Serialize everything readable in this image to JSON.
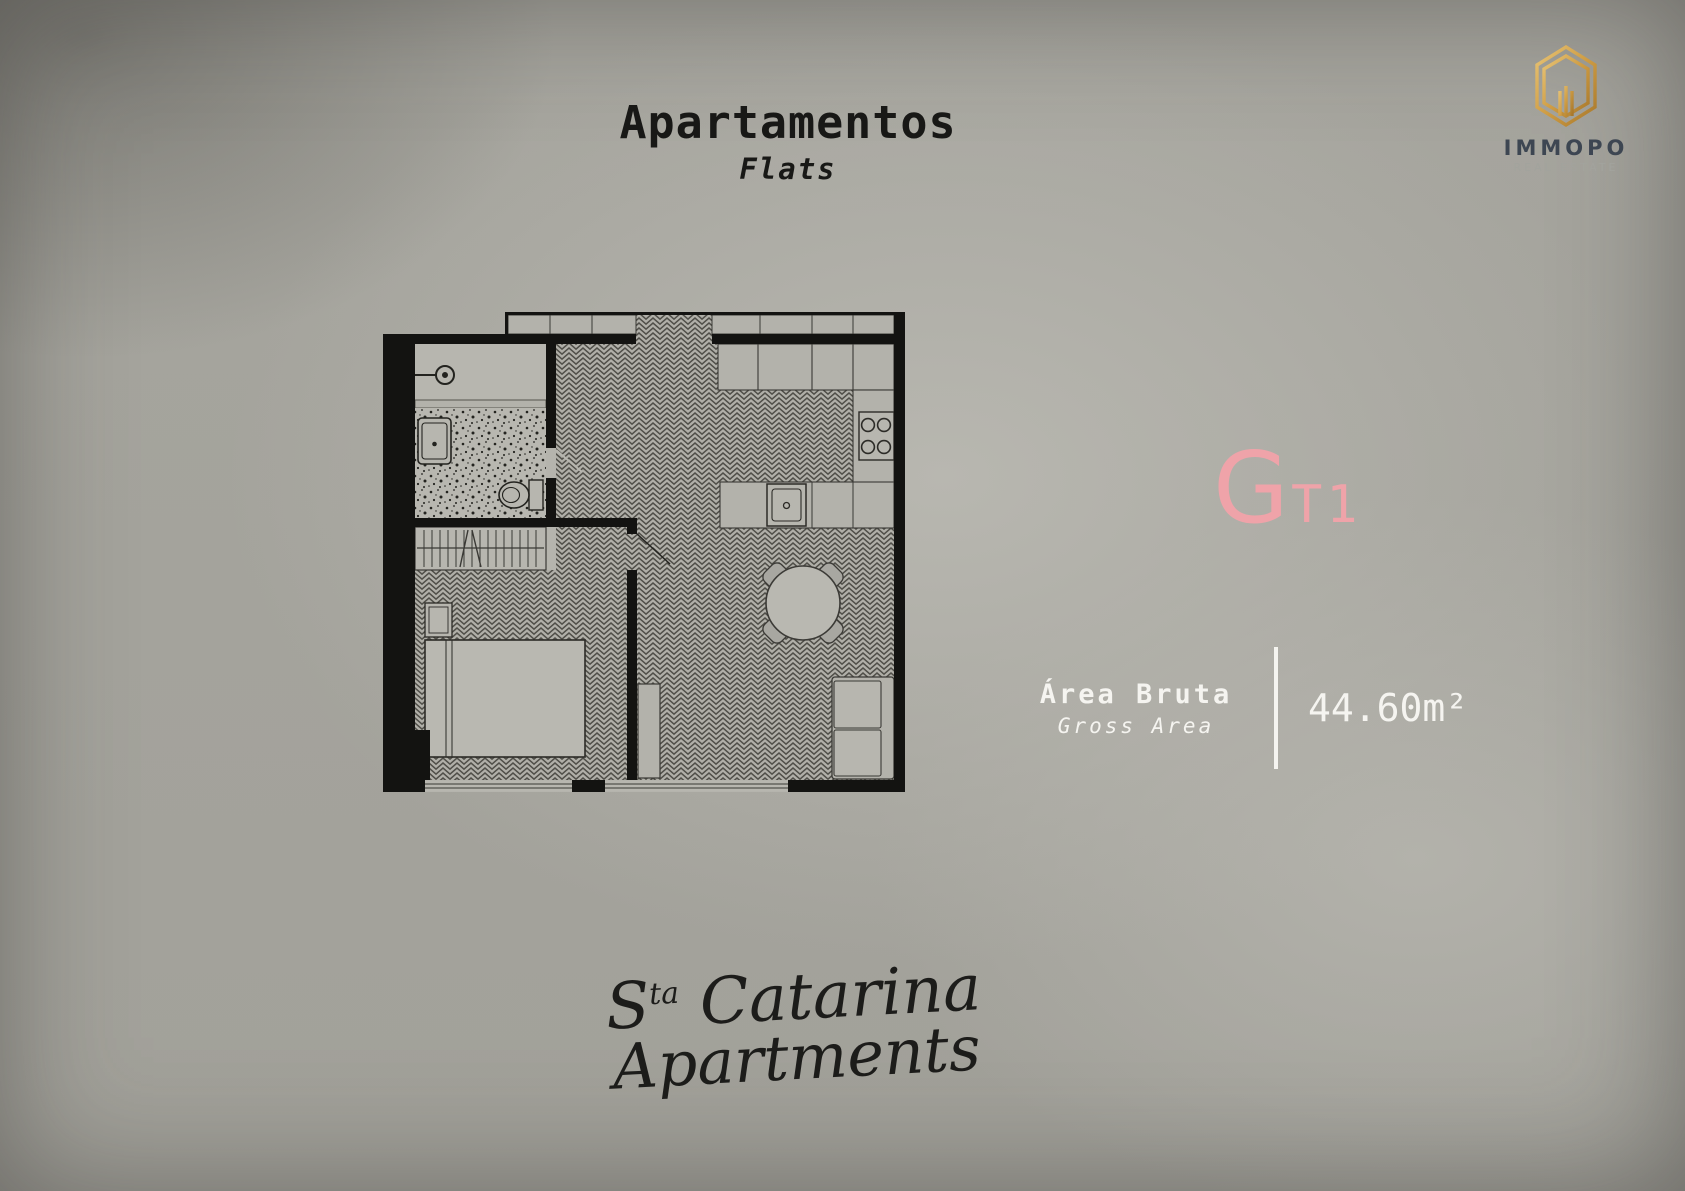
{
  "header": {
    "title": "Apartamentos",
    "subtitle": "Flats"
  },
  "brand": {
    "name": "IMMOPO",
    "tagline": "REAL ESTATE",
    "gold": "#d2a14f",
    "navy": "#3d4652"
  },
  "unit": {
    "letter": "G",
    "code": "T1",
    "accent": "#efa3a9"
  },
  "area": {
    "label": "Área Bruta",
    "sublabel": "Gross Area",
    "value": "44.60m²"
  },
  "signature": {
    "line1_prefix": "S",
    "line1_sup": "ta",
    "line1_rest": "Catarina",
    "line2": "Apartments"
  },
  "colors": {
    "background": "#a6a59e",
    "text_dark": "#181816",
    "text_light": "#f5f4f0",
    "wall_black": "#131311"
  },
  "floorplan": {
    "icons": [
      "entry-door-icon",
      "bathroom-sink",
      "toilet",
      "wardrobe-rail",
      "nightstand",
      "bed",
      "top-cabinets",
      "kitchen-upper-counter",
      "stove-hob",
      "kitchen-sink",
      "dining-table",
      "dining-chair",
      "sideboard",
      "sofa",
      "window-bedroom",
      "window-living"
    ]
  }
}
